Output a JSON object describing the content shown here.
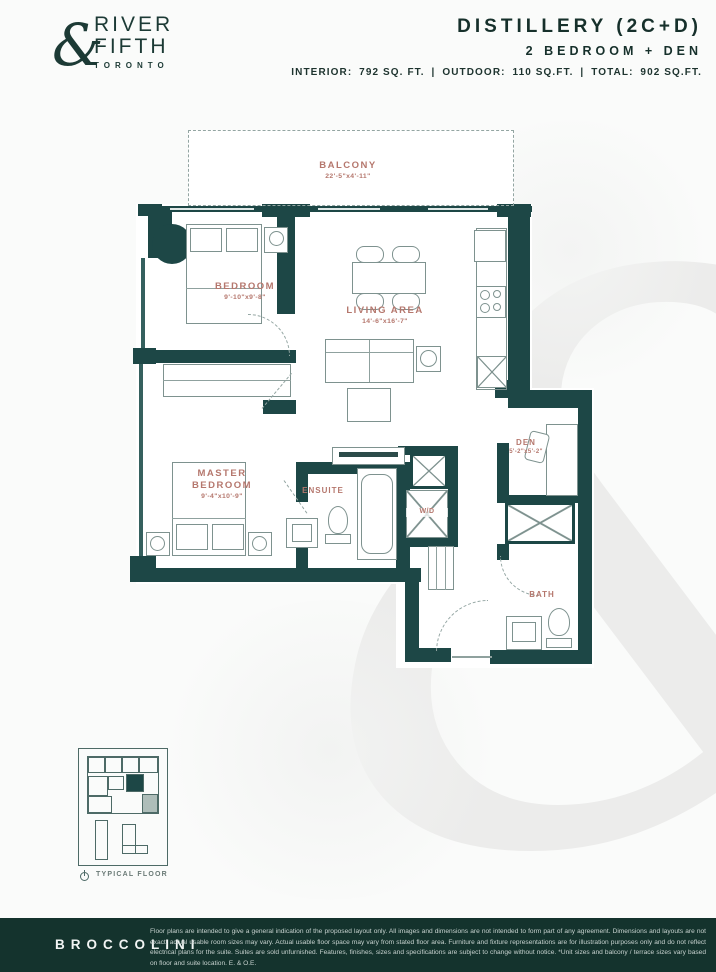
{
  "header": {
    "brand": {
      "name_top": "RIVER",
      "name_bottom": "FIFTH",
      "ampersand": "&",
      "city": "TORONTO"
    },
    "unit_name": "DISTILLERY (2C+D)",
    "unit_type": "2 BEDROOM + DEN",
    "area_line": {
      "interior_label": "INTERIOR:",
      "interior_value": "792 SQ. FT.",
      "divider": "|",
      "outdoor_label": "OUTDOOR:",
      "outdoor_value": "110 SQ.FT.",
      "total_label": "TOTAL:",
      "total_value": "902 SQ.FT."
    }
  },
  "floorplan": {
    "balcony": {
      "name": "BALCONY",
      "dims": "22'-5\"x4'-11\""
    },
    "bedroom": {
      "name": "BEDROOM",
      "dims": "9'-10\"x9'-8\""
    },
    "living": {
      "name": "LIVING AREA",
      "dims": "14'-6\"x16'-7\""
    },
    "master": {
      "name": "MASTER BEDROOM",
      "dims": "9'-4\"x10'-9\""
    },
    "ensuite": {
      "name": "ENSUITE"
    },
    "wd": {
      "name": "W/D"
    },
    "den": {
      "name": "DEN",
      "dims": "5'-2\"x5'-2\""
    },
    "bath": {
      "name": "BATH"
    },
    "keyplan": {
      "label": "TYPICAL FLOOR"
    }
  },
  "watermark": {
    "glyph": "&"
  },
  "footer": {
    "brand": "BROCCOLINI",
    "disclaimer": "Floor plans are intended to give a general indication of the proposed layout only. All images and dimensions are not intended to form part of any agreement. Dimensions and layouts are not exact, actual usable room sizes may vary. Actual usable floor space may vary from stated floor area. Furniture and fixture representations are for illustration purposes only and do not reflect electrical plans for the suite. Suites are sold unfurnished. Features, finishes, sizes and specifications are subject to change without notice. *Unit sizes and balcony / terrace sizes vary based on floor and suite location. E. & O.E."
  },
  "colors": {
    "wall": "#1d4746",
    "room_label": "#b5776d",
    "header_text": "#16302b",
    "footer_bg": "#14332d",
    "thin_line": "#7e928f",
    "watermark": "#ececeb"
  }
}
